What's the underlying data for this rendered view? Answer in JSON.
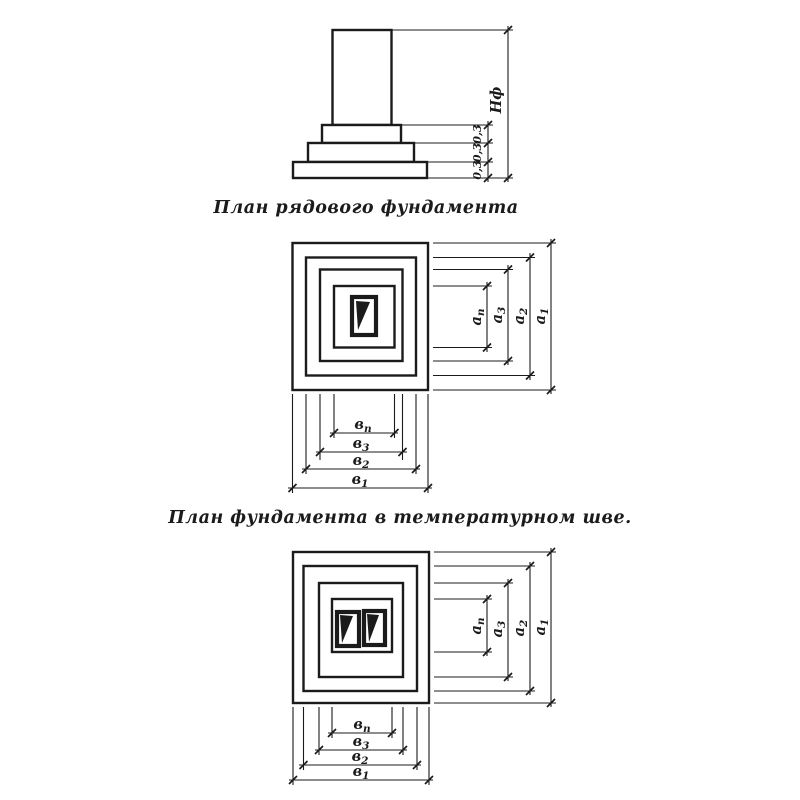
{
  "colors": {
    "line": "#1b1b1b",
    "background": "#ffffff"
  },
  "elevation": {
    "height_label": "Нф",
    "step_dims": [
      "0,3",
      "0,3",
      "0,3"
    ]
  },
  "plan_single": {
    "caption": "План рядового фундамента",
    "vdims": [
      {
        "base": "а",
        "sub": "п"
      },
      {
        "base": "а",
        "sub": "3"
      },
      {
        "base": "а",
        "sub": "2"
      },
      {
        "base": "а",
        "sub": "1"
      }
    ],
    "hdims": [
      {
        "base": "в",
        "sub": "п"
      },
      {
        "base": "в",
        "sub": "3"
      },
      {
        "base": "в",
        "sub": "2"
      },
      {
        "base": "в",
        "sub": "1"
      }
    ]
  },
  "plan_double": {
    "caption": "План фундамента в температурном шве.",
    "vdims": [
      {
        "base": "а",
        "sub": "п"
      },
      {
        "base": "а",
        "sub": "3"
      },
      {
        "base": "а",
        "sub": "2"
      },
      {
        "base": "а",
        "sub": "1"
      }
    ],
    "hdims": [
      {
        "base": "в",
        "sub": "п"
      },
      {
        "base": "в",
        "sub": "3"
      },
      {
        "base": "в",
        "sub": "2"
      },
      {
        "base": "в",
        "sub": "1"
      }
    ]
  }
}
